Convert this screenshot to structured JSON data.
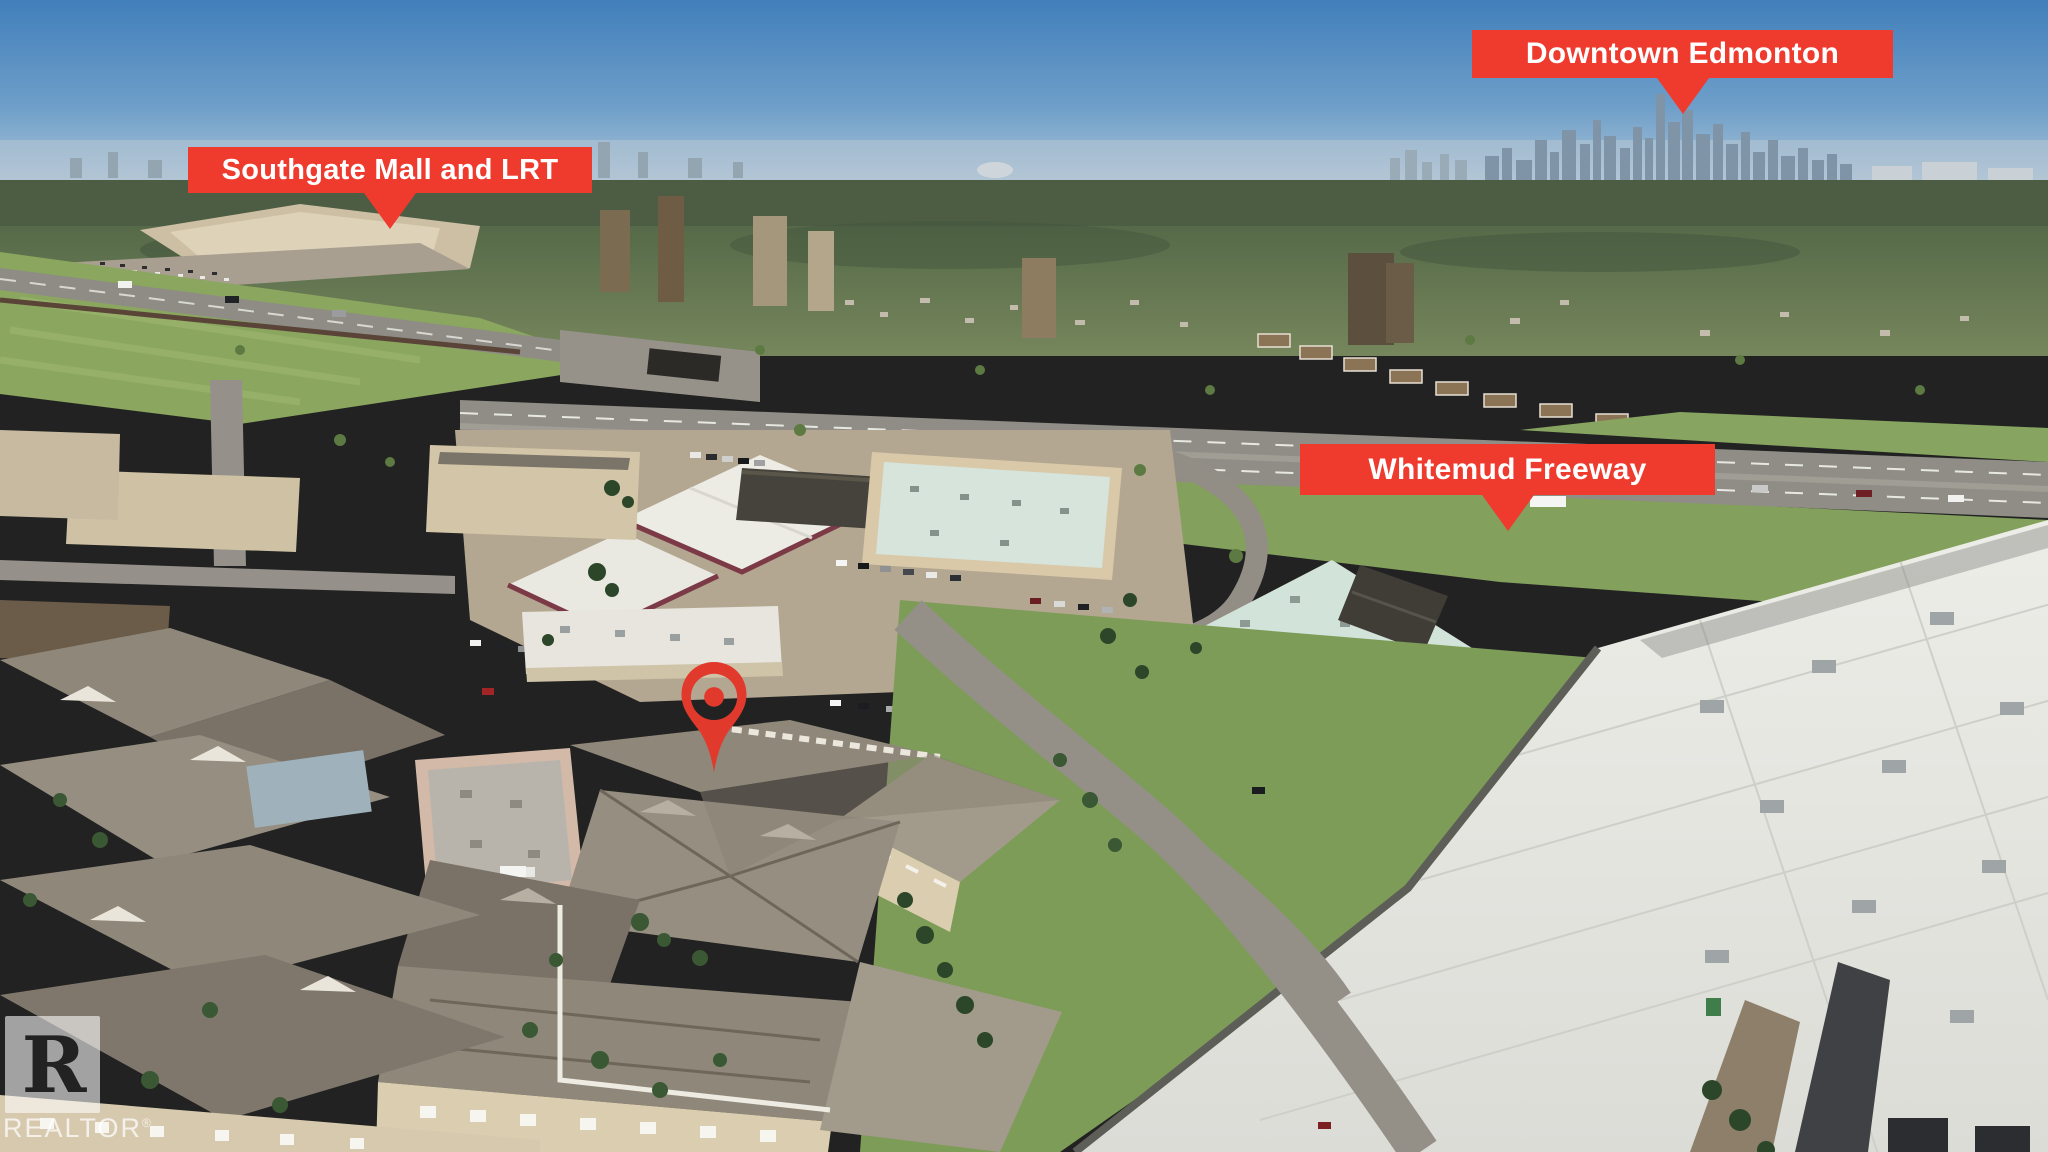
{
  "annotations": {
    "banner_color": "#ef3a2e",
    "pin_color": "#e13a2d",
    "label_text_color": "#ffffff",
    "labels": [
      {
        "id": "downtown-edmonton",
        "text": "Downtown Edmonton"
      },
      {
        "id": "southgate-mall-lrt",
        "text": "Southgate Mall and LRT"
      },
      {
        "id": "whitemud-freeway",
        "text": "Whitemud Freeway"
      }
    ]
  },
  "watermark": {
    "logo_letter": "R",
    "text": "REALTOR",
    "registered_mark": "®"
  }
}
